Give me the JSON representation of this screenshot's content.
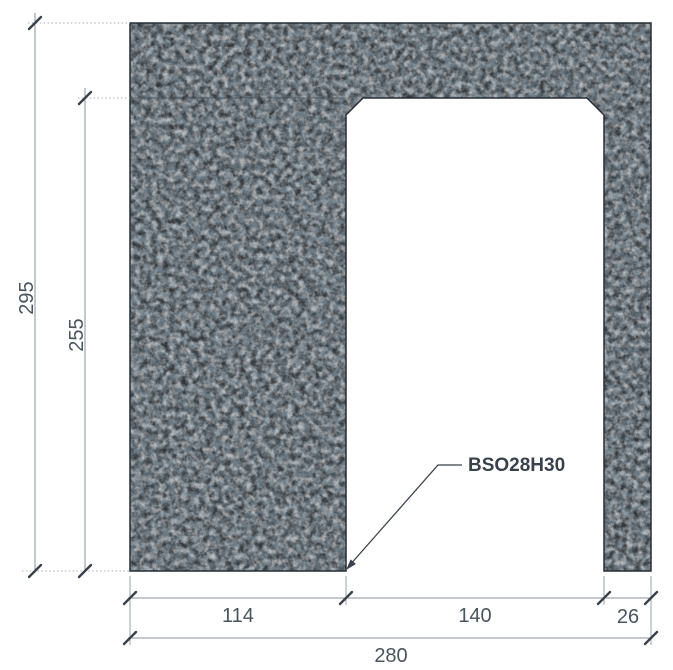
{
  "drawing": {
    "part_label": "BSO28H30",
    "dimensions": {
      "total_height": "295",
      "opening_height": "255",
      "left_leg_width": "114",
      "opening_width": "140",
      "right_leg_width": "26",
      "total_width": "280"
    },
    "colors": {
      "concrete_base": "#6f7b84",
      "concrete_dark_speckle": "#49545d",
      "concrete_light_speckle": "#87929a",
      "outline": "#262d34",
      "dimension_line": "#8a9298",
      "tick_and_arrow": "#39424c",
      "dimension_text": "#4a545e",
      "label_text": "#39424c",
      "background": "#ffffff"
    }
  }
}
